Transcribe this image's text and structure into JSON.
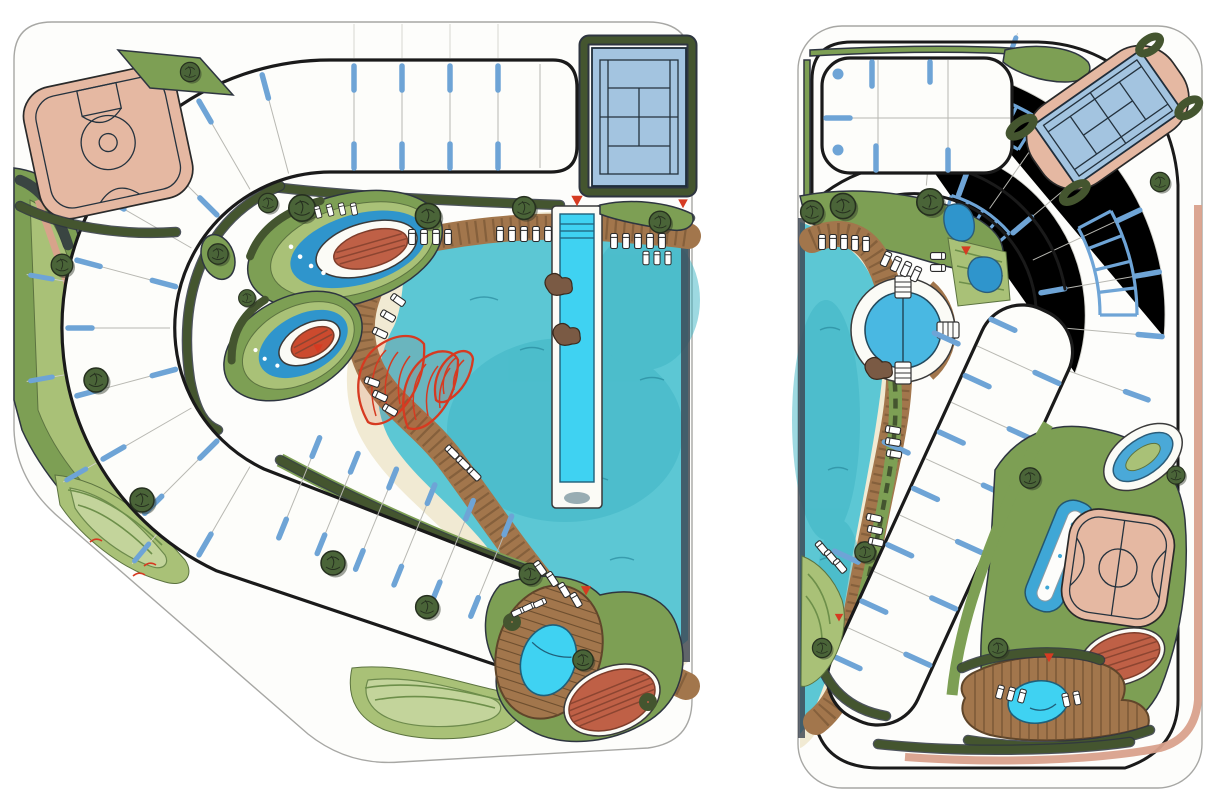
{
  "document": {
    "kind": "Hand-rendered resort lagoon master plan, two alternative schemes side by side"
  },
  "palette": {
    "paper": "#ffffff",
    "outline_thin": "#a7a7a4",
    "outline_bold": "#1a1a1a",
    "plot_blue": "#6ea4d6",
    "lagoon_water": "#5cc7d4",
    "lagoon_deep": "#3db4c4",
    "pool_cyan": "#3fd2f2",
    "pod_blue": "#2f95cc",
    "sand": "#f1ead3",
    "wood": "#a2764c",
    "wood_dark": "#6e4f2f",
    "hedge_dark": "#44552f",
    "green_mid": "#7d9f54",
    "green_light": "#a9c177",
    "lawn": "#c3d49b",
    "court_salmon": "#e5b8a2",
    "court_blue": "#a3c4e0",
    "terracotta": "#bf6046",
    "terracotta_line": "#8c4531",
    "pink_path": "#d9a18c",
    "sculpture_red": "#d63a21",
    "marker_red": "#d63b22"
  },
  "plans": [
    {
      "id": "west-scheme",
      "features": [
        "basketball-court",
        "tennis-court",
        "c-shaped-plot-ring",
        "radial-plot-dividers",
        "central-lagoon",
        "sand-beach",
        "winding-boardwalk",
        "pier-lap-pool",
        "spa-garden-pod",
        "spa-garden-pod-small",
        "red-shade-sails",
        "oval-pool-deck",
        "cyan-pool",
        "terracotta-patio",
        "berm-lawn-park",
        "perimeter-green-walk",
        "lounge-chairs",
        "canopy-trees",
        "entry-markers"
      ]
    },
    {
      "id": "east-scheme",
      "features": [
        "entry-court-pad",
        "radial-plot-fan",
        "curved-unit-rows",
        "rotated-tennis-court",
        "west-lagoon",
        "sand-beach",
        "diagonal-boardwalk",
        "circular-plunge-pool",
        "diagonal-plot-bar",
        "running-oval",
        "basketball-court",
        "lap-pool",
        "pool-deck",
        "cyan-pool",
        "terracotta-patios",
        "perimeter-pink-path",
        "lounge-chairs",
        "canopy-trees",
        "entry-markers"
      ]
    }
  ]
}
